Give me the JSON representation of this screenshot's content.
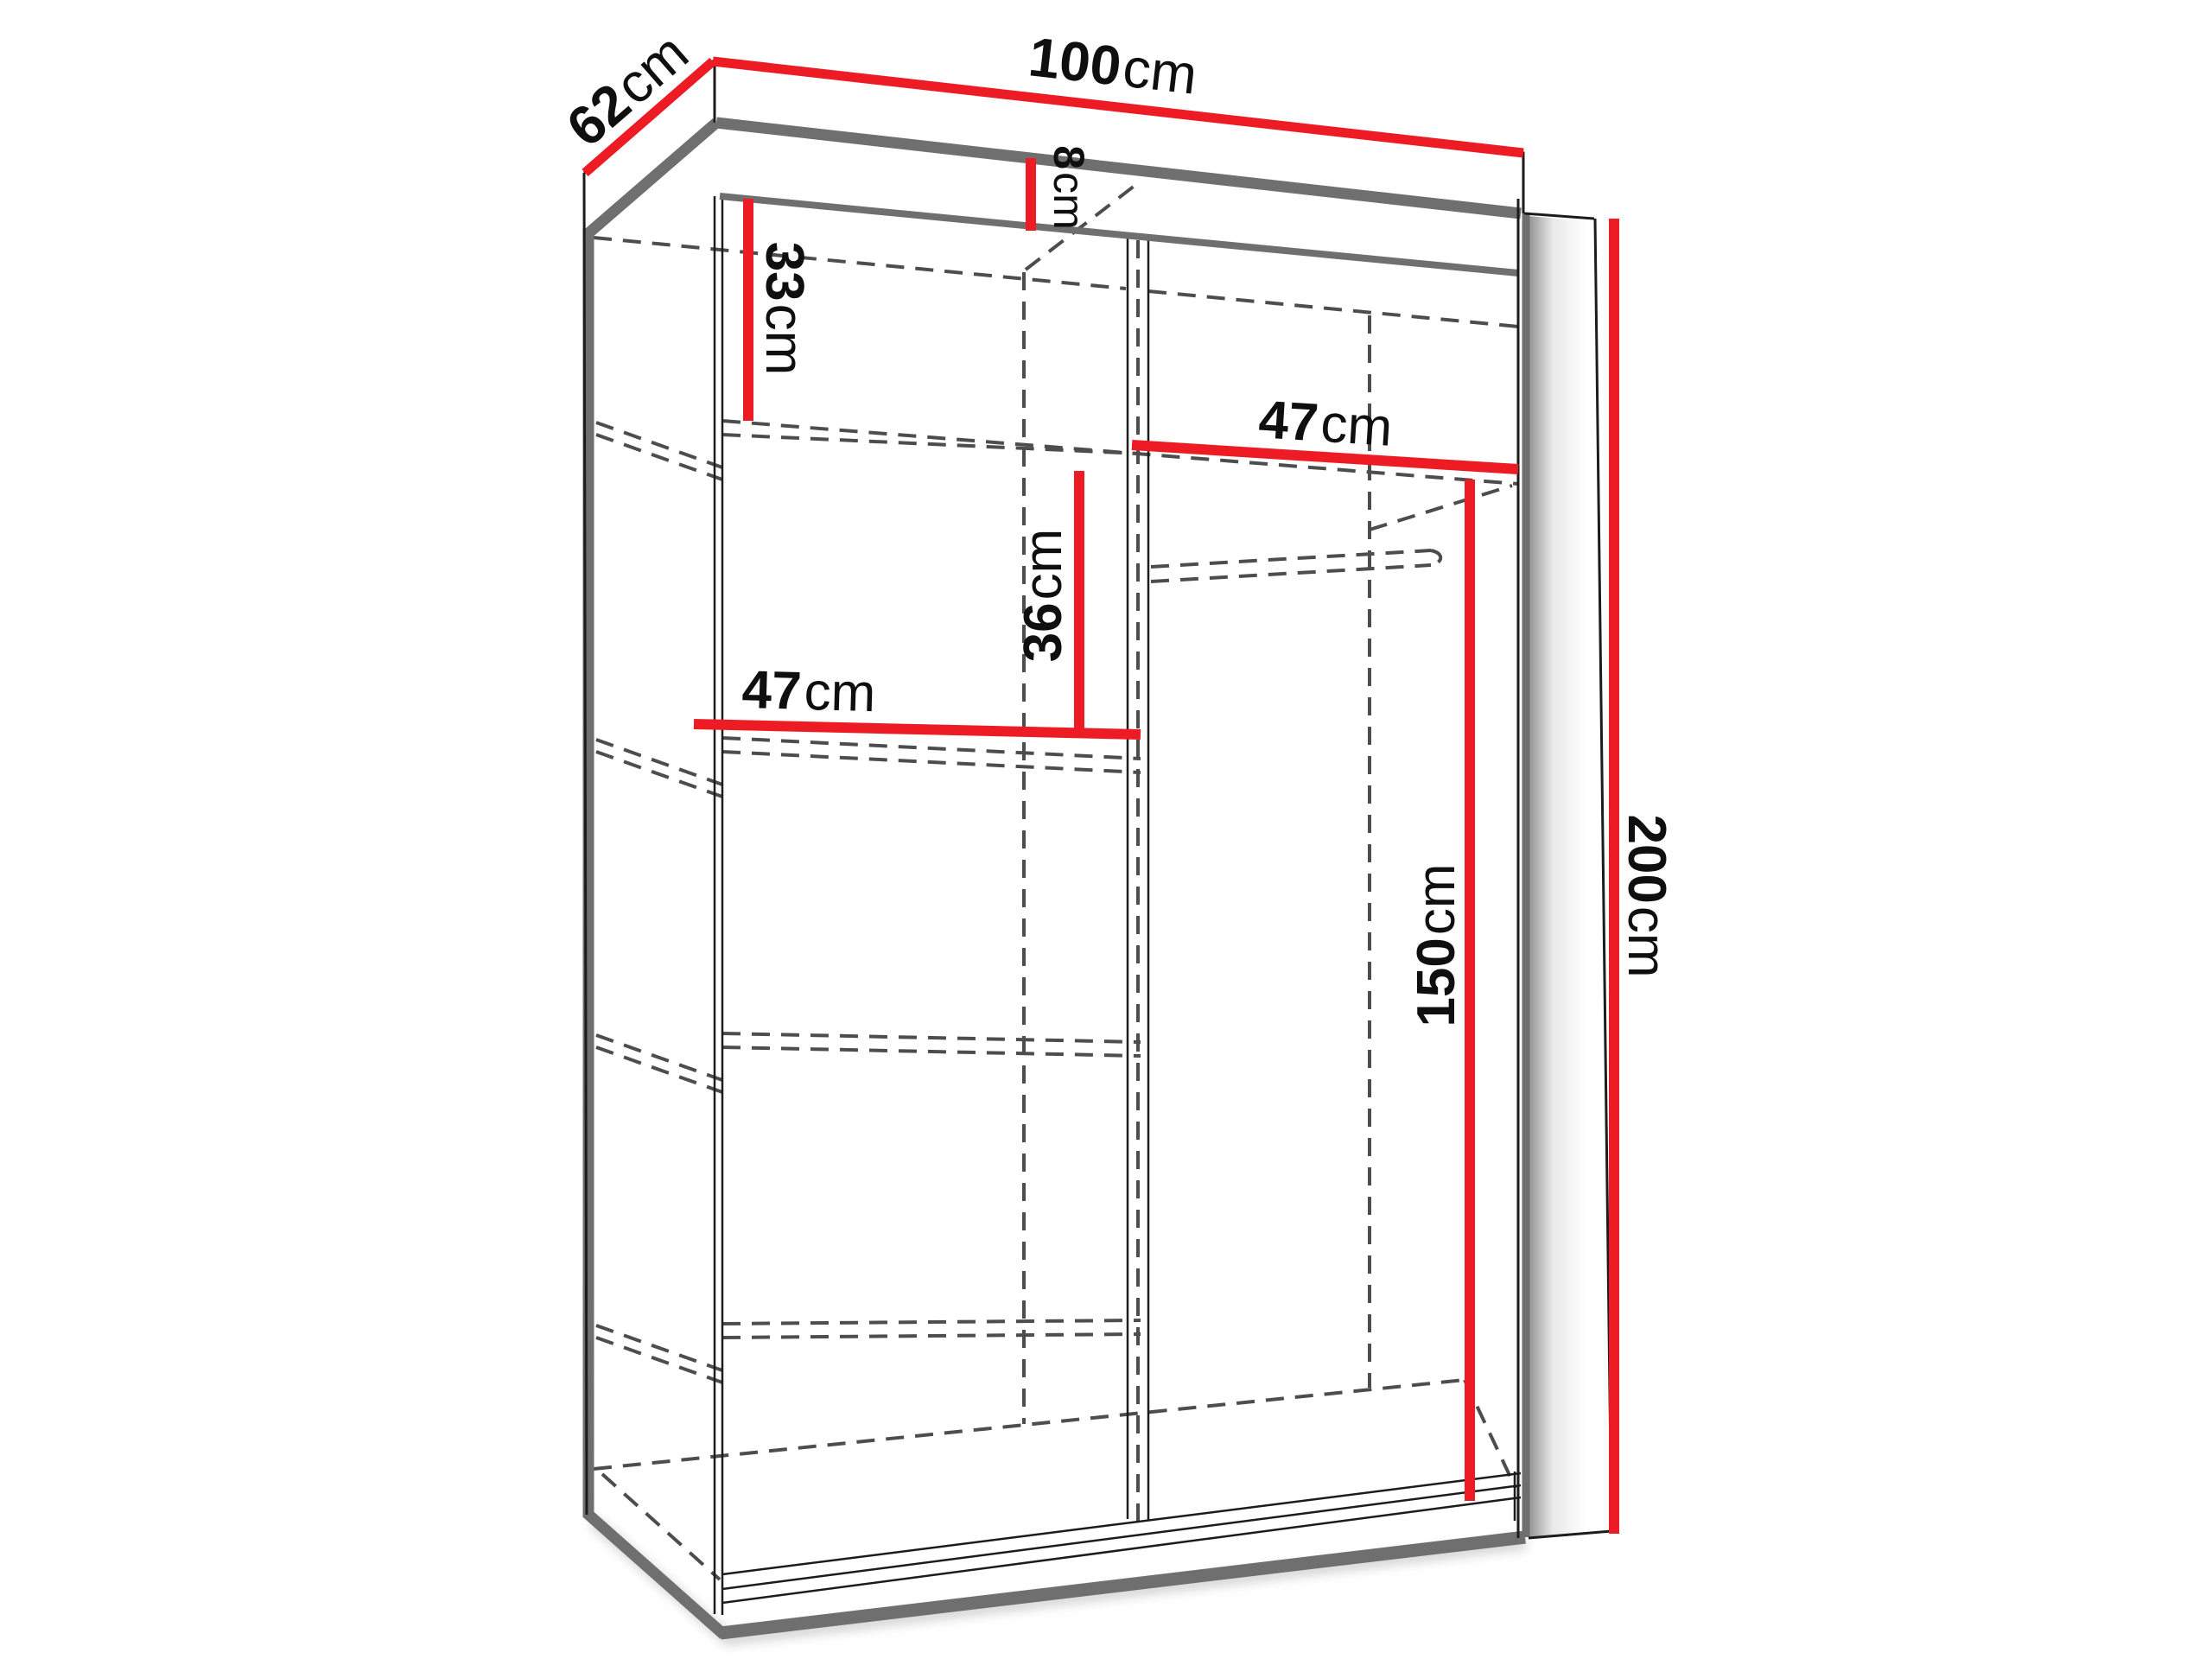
{
  "diagram": {
    "type": "wardrobe-dimension-diagram",
    "unit": "cm",
    "dimensions": {
      "depth": {
        "value": "62",
        "unit": "cm"
      },
      "width": {
        "value": "100",
        "unit": "cm"
      },
      "top_rail": {
        "value": "8",
        "unit": "cm"
      },
      "top_section": {
        "value": "33",
        "unit": "cm"
      },
      "right_shelf_width": {
        "value": "47",
        "unit": "cm"
      },
      "shelf_spacing": {
        "value": "36",
        "unit": "cm"
      },
      "left_shelf_width": {
        "value": "47",
        "unit": "cm"
      },
      "hanging_height": {
        "value": "150",
        "unit": "cm"
      },
      "total_height": {
        "value": "200",
        "unit": "cm"
      }
    },
    "colors": {
      "dimension_red": "#ed1c24",
      "outline_black": "#1c1c1c",
      "panel_gray": "#6f6f6f",
      "hidden_line_gray": "#4d4d4d",
      "background": "#ffffff"
    }
  }
}
